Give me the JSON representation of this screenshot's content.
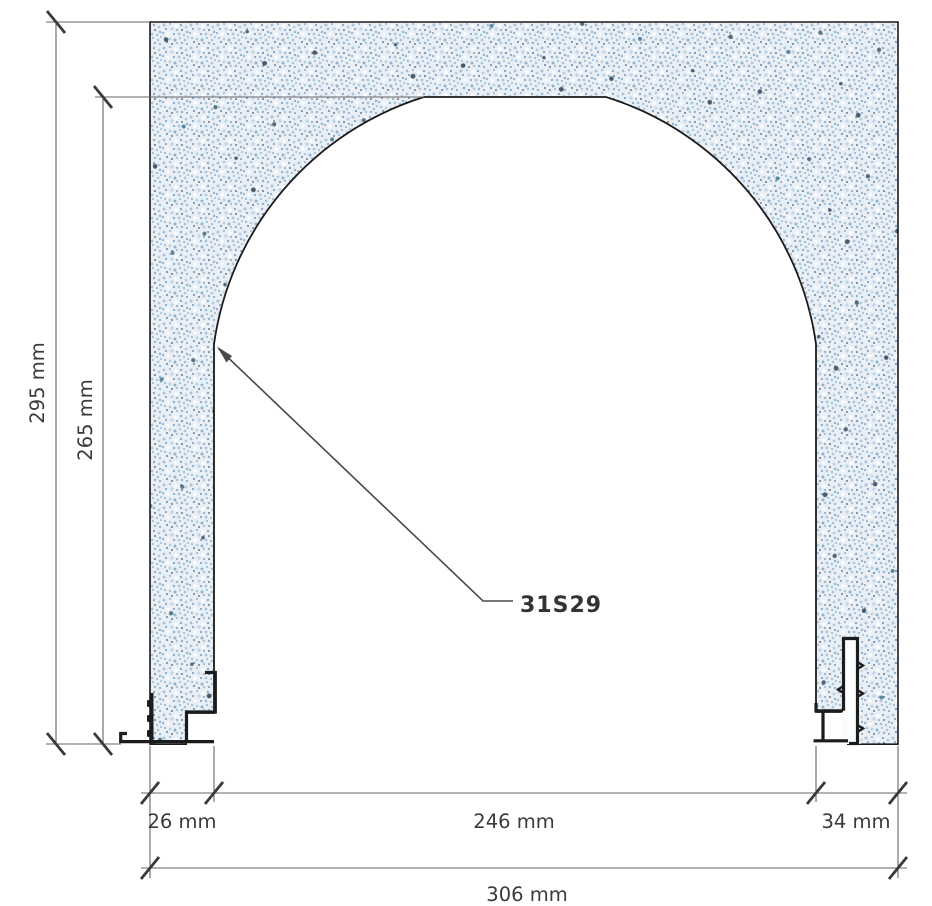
{
  "drawing": {
    "type": "technical-section-drawing",
    "subject": "arched wall opening cross-section with edge profiles",
    "system_label": "31S29",
    "dimensions": {
      "total_height": "295 mm",
      "opening_height": "265 mm",
      "left_jamb_width": "26 mm",
      "opening_width": "246 mm",
      "right_jamb_width": "34 mm",
      "total_width": "306 mm"
    },
    "colors": {
      "wall_base": "#e9eff5",
      "speckle_light": "#b3cbdf",
      "speckle_mid": "#8fb2cf",
      "speckle_deep": "#6f98c0",
      "speckle_dark": "#2e4257",
      "outline": "#1a1a1a",
      "profile": "#1c1c1c",
      "dimension_line": "#666666",
      "tick": "#3a3a3a",
      "text": "#3a3a3a"
    }
  }
}
